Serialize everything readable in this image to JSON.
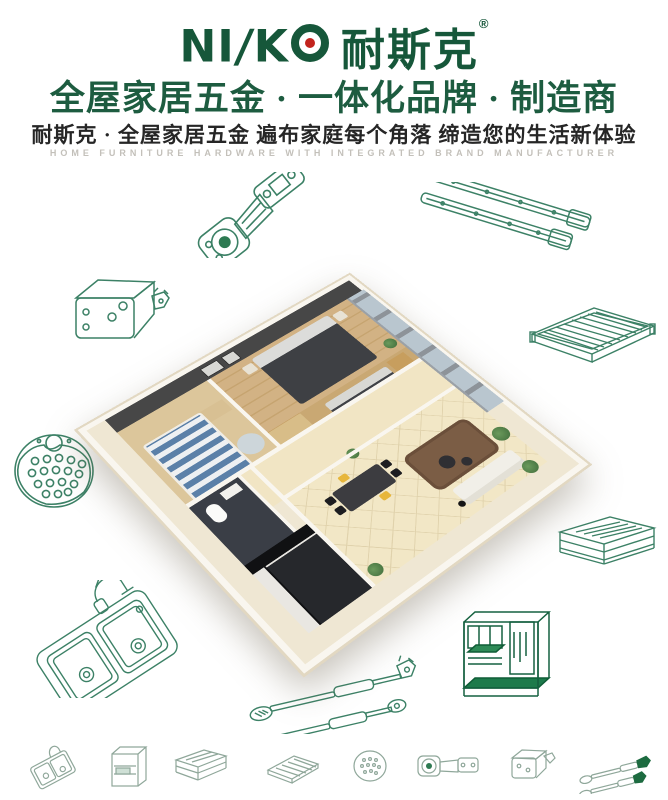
{
  "brand": {
    "logo": {
      "part1": "NI",
      "slash": "/",
      "part2": "K"
    },
    "logo_cn": "耐斯克",
    "registered": "®"
  },
  "header": {
    "headline": "全屋家居五金 · 一体化品牌 · 制造商",
    "subheadline": "耐斯克 · 全屋家居五金  遍布家庭每个角落  缔造您的生活新体验",
    "tagline_en": "HOME FURNITURE HARDWARE WITH INTEGRATED BRAND MANUFACTURER"
  },
  "colors": {
    "brand_green": "#16573a",
    "headline_green": "#1d5c40",
    "sketch_green": "#3c8166",
    "icon_gray_green": "#8fa79a",
    "logo_red": "#c2241d",
    "subheadline_dark": "#262626",
    "tagline_gray": "#c3c0ba"
  },
  "sketches": [
    {
      "name": "concealed-hinge-sketch"
    },
    {
      "name": "drawer-slides-sketch"
    },
    {
      "name": "cabinet-bracket-sketch"
    },
    {
      "name": "wire-shelf-sketch"
    },
    {
      "name": "perforated-plate-sketch"
    },
    {
      "name": "wire-basket-sketch"
    },
    {
      "name": "kitchen-sink-faucet-sketch"
    },
    {
      "name": "gas-lift-struts-sketch"
    },
    {
      "name": "kitchen-wire-rack-sketch"
    }
  ],
  "bottom_icons": [
    {
      "name": "sink-icon"
    },
    {
      "name": "wire-cabinet-icon"
    },
    {
      "name": "wire-basket-icon"
    },
    {
      "name": "wire-shelf-icon"
    },
    {
      "name": "perforated-plate-icon"
    },
    {
      "name": "hinge-icon"
    },
    {
      "name": "bracket-icon"
    },
    {
      "name": "gas-strut-icon"
    }
  ]
}
